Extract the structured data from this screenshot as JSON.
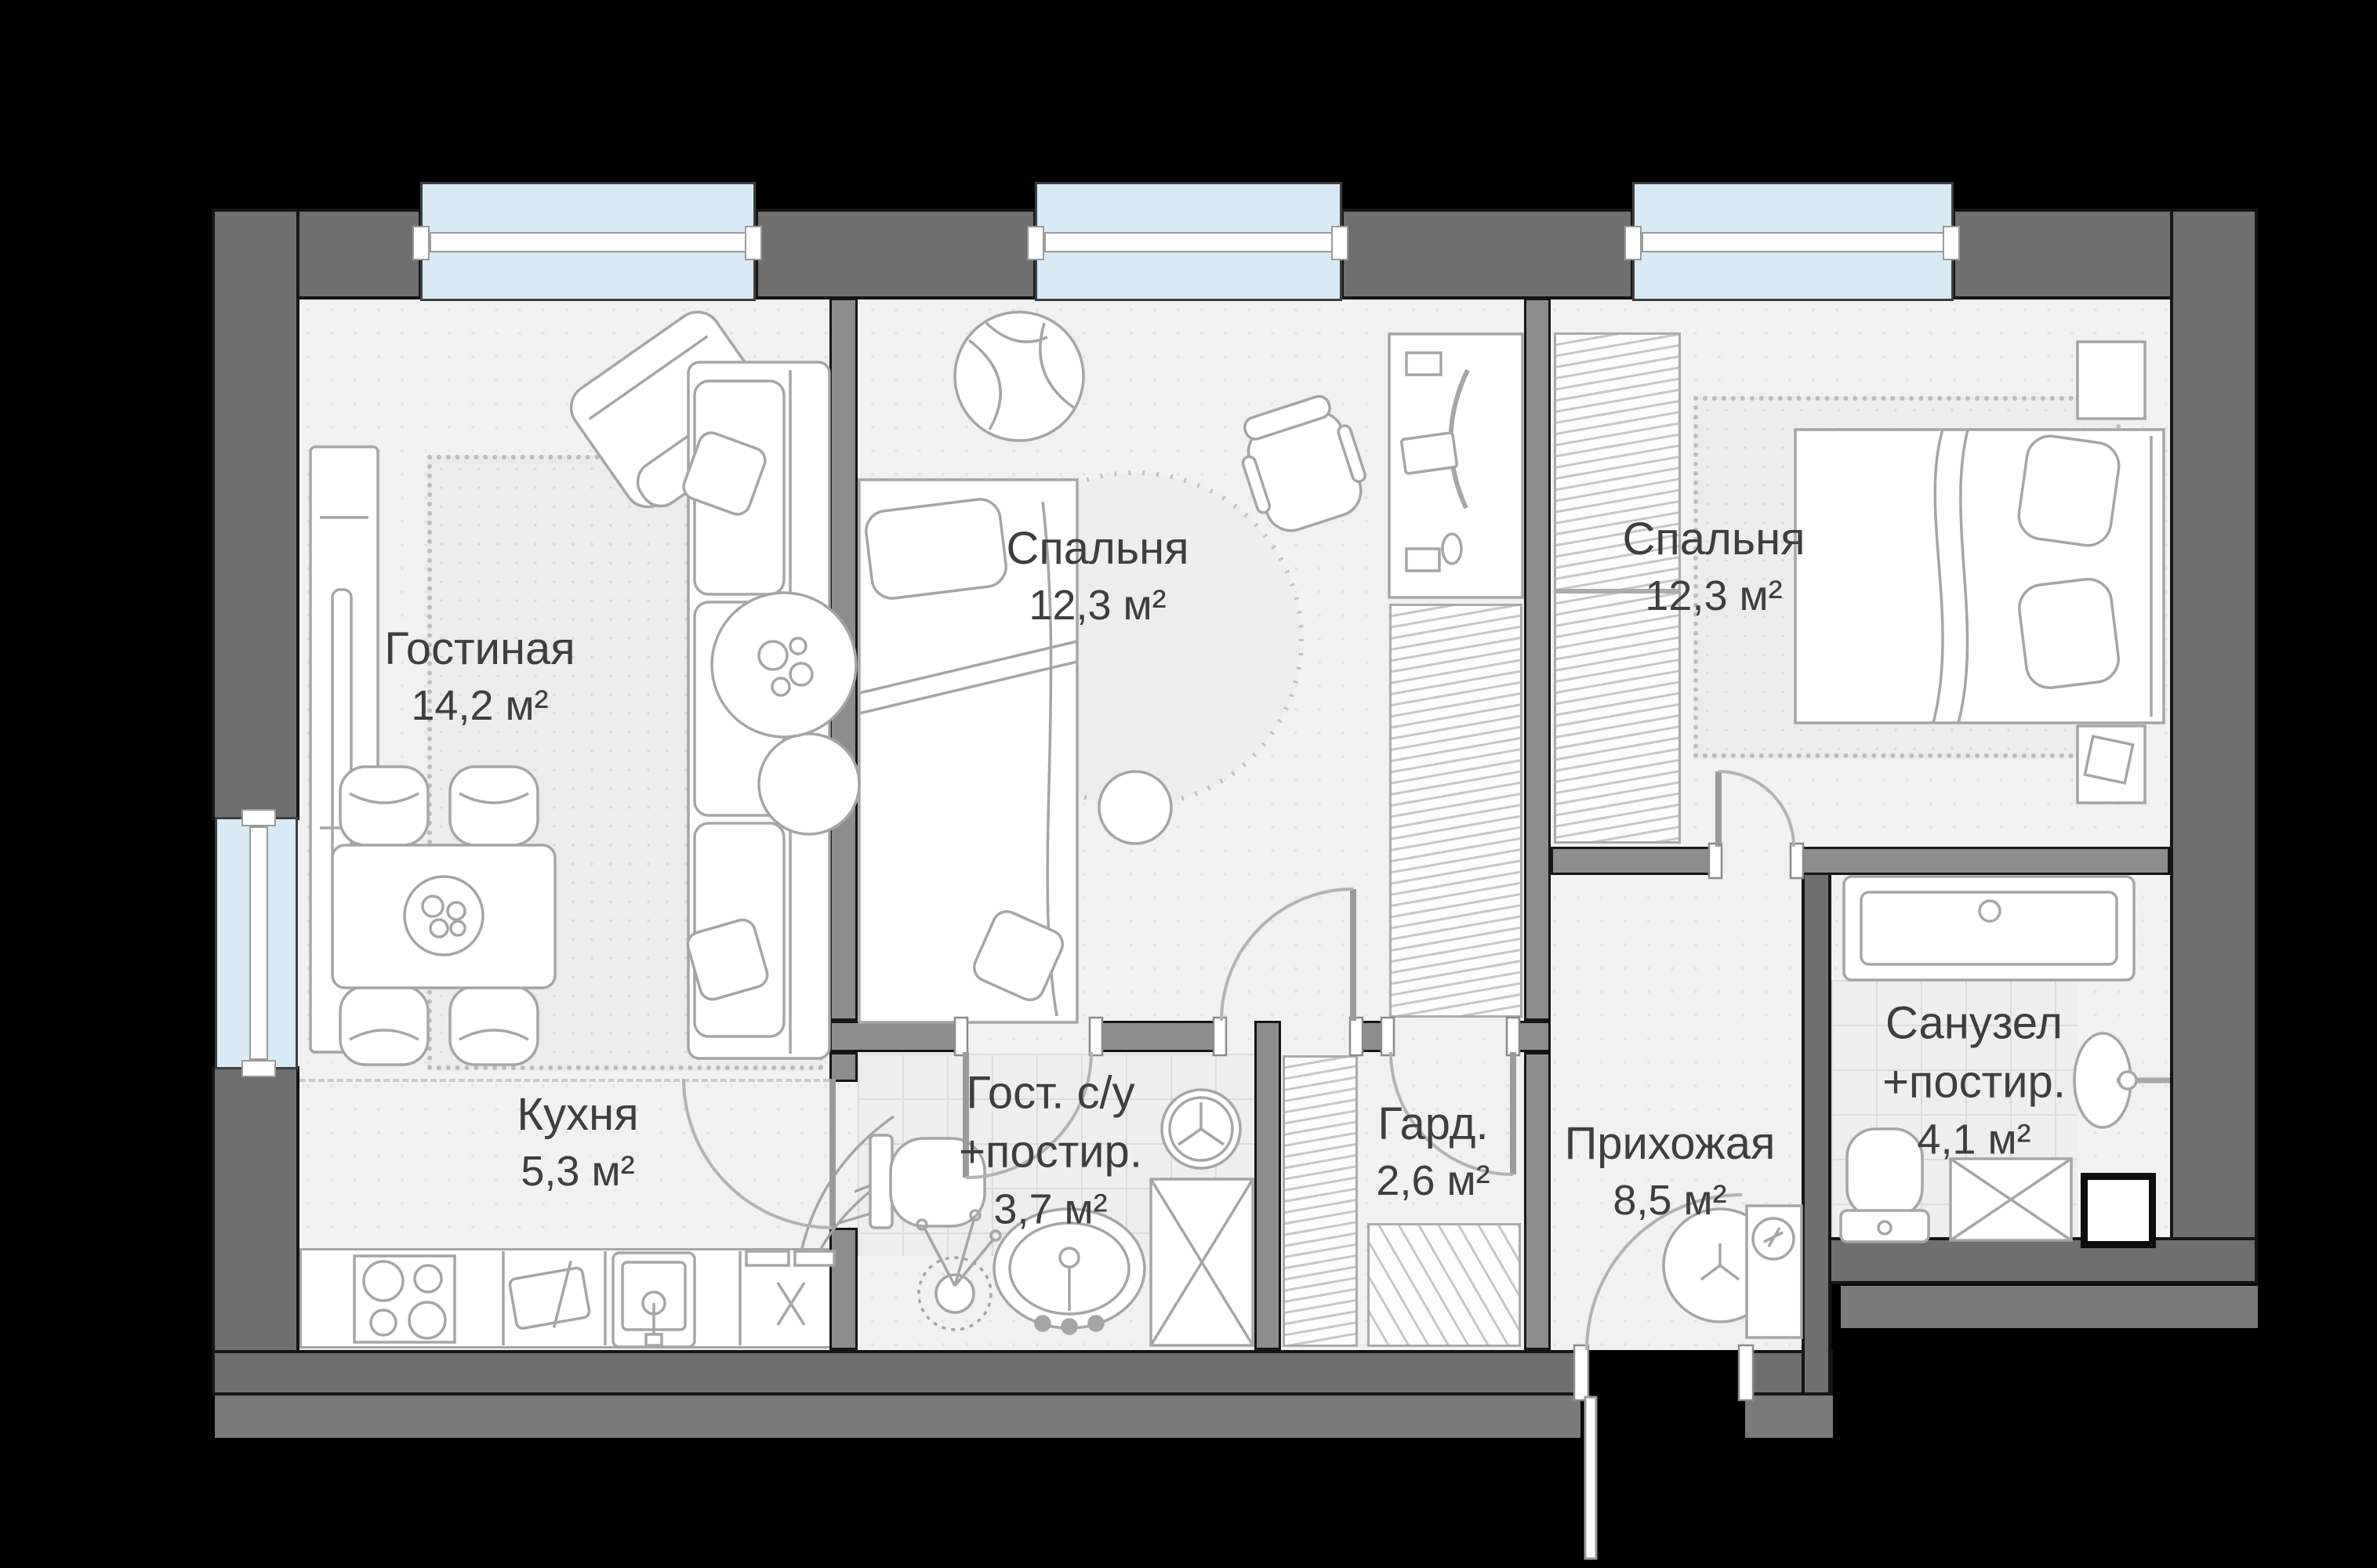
{
  "rooms": [
    {
      "id": "living",
      "name": "Гостиная",
      "area": "14,2 м²"
    },
    {
      "id": "bedroom-1",
      "name": "Спальня",
      "area": "12,3 м²"
    },
    {
      "id": "bedroom-2",
      "name": "Спальня",
      "area": "12,3 м²"
    },
    {
      "id": "kitchen",
      "name": "Кухня",
      "area": "5,3 м²"
    },
    {
      "id": "guest-bathroom",
      "name": "Гост. с/у",
      "name2": "+постир.",
      "area": "3,7 м²"
    },
    {
      "id": "wardrobe",
      "name": "Гард.",
      "area": "2,6 м²"
    },
    {
      "id": "hallway",
      "name": "Прихожая",
      "area": "8,5 м²"
    },
    {
      "id": "bathroom",
      "name": "Санузел",
      "name2": "+постир.",
      "area": "4,1 м²"
    }
  ],
  "colors": {
    "background": "#000000",
    "outer_wall": "#6f6f6f",
    "inner_wall": "#8d8d8d",
    "floor": "#f1f1f1",
    "window": "#d8eaf5",
    "text": "#3e3e3e"
  }
}
